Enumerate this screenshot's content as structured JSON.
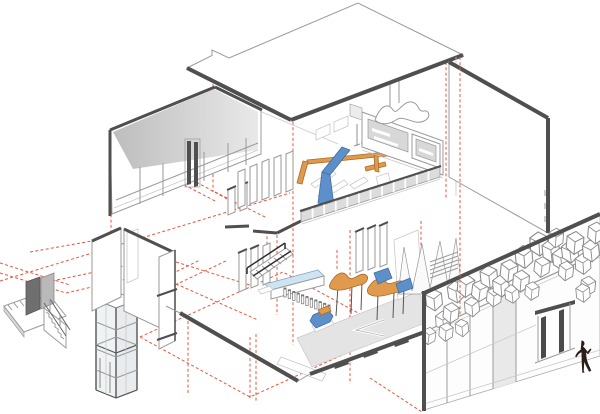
{
  "diagram": {
    "kind": "axonometric cutaway architectural drawing",
    "subject": "two-level gallery interior with exploded circulation elements",
    "components": [
      "roof-plane",
      "upper-gallery-floor",
      "ground-gallery-floor",
      "exploded-side-stair",
      "elevator-shaft-cage",
      "corridor-wall-fragment",
      "right-wall-panel",
      "hexagon-tile-facade",
      "entry-doors",
      "walking-figure",
      "red-projection-lines"
    ]
  },
  "palette": {
    "edge": "#4f4f4f",
    "line": "#9a9a9a",
    "lineLight": "#c9c9c9",
    "red": "#e4573e",
    "blue": "#5d8fc9",
    "blueDark": "#3f6fa8",
    "orange": "#e09a4e",
    "orangeDark": "#ad6b22",
    "glass": "#cfe4f2",
    "grayFill": "#d8d8d8",
    "lightFill": "#ececec",
    "bandFrom": "#bdbdbd",
    "bandTo": "#e9e9e9",
    "figure": "#2b1d19",
    "panelDark": "#6f6f6f"
  },
  "facade": {
    "glazing_mullion_count": 4,
    "door_leaves": 2,
    "hexagons": [
      [
        434,
        300,
        1.0,
        -6
      ],
      [
        429,
        336,
        0.8,
        8
      ],
      [
        443,
        321,
        0.9,
        -4
      ],
      [
        451,
        313,
        0.95,
        6
      ],
      [
        456,
        292,
        1.0,
        -8
      ],
      [
        466,
        286,
        1.05,
        4
      ],
      [
        472,
        307,
        0.9,
        -5
      ],
      [
        480,
        291,
        1.0,
        7
      ],
      [
        489,
        277,
        1.05,
        -6
      ],
      [
        494,
        297,
        0.9,
        5
      ],
      [
        501,
        286,
        1.0,
        -4
      ],
      [
        509,
        271,
        1.05,
        6
      ],
      [
        512,
        294,
        0.85,
        -7
      ],
      [
        521,
        281,
        1.0,
        5
      ],
      [
        524,
        257,
        1.05,
        -5
      ],
      [
        532,
        291,
        0.85,
        6
      ],
      [
        539,
        244,
        1.1,
        -4
      ],
      [
        542,
        267,
        0.95,
        7
      ],
      [
        551,
        251,
        1.05,
        -6
      ],
      [
        556,
        238,
        0.9,
        4
      ],
      [
        561,
        259,
        1.0,
        -5
      ],
      [
        566,
        271,
        0.9,
        6
      ],
      [
        570,
        252,
        1.0,
        -7
      ],
      [
        575,
        243,
        1.05,
        5
      ],
      [
        583,
        264,
        0.95,
        -4
      ],
      [
        588,
        286,
        0.9,
        6
      ],
      [
        591,
        251,
        1.0,
        -6
      ],
      [
        596,
        233,
        1.0,
        4
      ],
      [
        583,
        293,
        0.85,
        -5
      ],
      [
        446,
        332,
        0.85,
        5
      ],
      [
        462,
        328,
        0.8,
        -6
      ]
    ]
  },
  "balustrade": {
    "panel_count": 12
  },
  "turnstiles": {
    "post_count": 11
  }
}
